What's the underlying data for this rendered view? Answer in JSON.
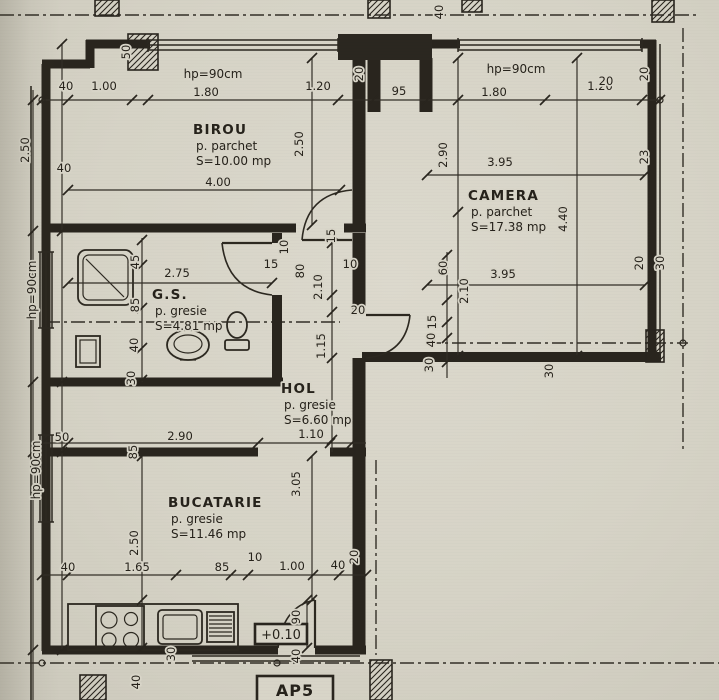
{
  "colors": {
    "paper": "#d8d5c8",
    "ink": "#26221b"
  },
  "plan": {
    "rooms": [
      {
        "id": "birou",
        "name": "BIROU",
        "floor_finish": "p. parchet",
        "area": "S=10.00 mp",
        "x": 193,
        "y": 134
      },
      {
        "id": "camera",
        "name": "CAMERA",
        "floor_finish": "p. parchet",
        "area": "S=17.38 mp",
        "x": 468,
        "y": 200
      },
      {
        "id": "gs",
        "name": "G.S.",
        "floor_finish": "p. gresie",
        "area": "S=4.81 mp",
        "x": 152,
        "y": 299
      },
      {
        "id": "hol",
        "name": "HOL",
        "floor_finish": "p. gresie",
        "area": "S=6.60 mp",
        "x": 281,
        "y": 393
      },
      {
        "id": "bucatarie",
        "name": "BUCATARIE",
        "floor_finish": "p. gresie",
        "area": "S=11.46 mp",
        "x": 168,
        "y": 507
      }
    ],
    "window_labels": [
      {
        "text": "hp=90cm",
        "x": 213,
        "y": 78,
        "r": 0
      },
      {
        "text": "hp=90cm",
        "x": 516,
        "y": 73,
        "r": 0
      },
      {
        "text": "hp=90cm",
        "x": 36,
        "y": 290,
        "r": -90
      },
      {
        "text": "hp=90cm",
        "x": 40,
        "y": 470,
        "r": -90
      }
    ],
    "level_marker": "+0.10",
    "plan_code": "AP5",
    "dims": [
      {
        "t": "40",
        "x": 66,
        "y": 90,
        "r": 0
      },
      {
        "t": "1.00",
        "x": 104,
        "y": 90,
        "r": 0
      },
      {
        "t": "1.80",
        "x": 206,
        "y": 96,
        "r": 0
      },
      {
        "t": "1.20",
        "x": 318,
        "y": 90,
        "r": 0
      },
      {
        "t": "95",
        "x": 399,
        "y": 95,
        "r": 0
      },
      {
        "t": "1.80",
        "x": 494,
        "y": 96,
        "r": 0
      },
      {
        "t": "1.20",
        "x": 600,
        "y": 90,
        "r": 0
      },
      {
        "t": "50",
        "x": 130,
        "y": 52,
        "r": -90
      },
      {
        "t": "40",
        "x": 443,
        "y": 12,
        "r": -90
      },
      {
        "t": "20",
        "x": 606,
        "y": 85,
        "r": 0
      },
      {
        "t": "20",
        "x": 648,
        "y": 74,
        "r": -90
      },
      {
        "t": "20",
        "x": 363,
        "y": 74,
        "r": -90
      },
      {
        "t": "2.50",
        "x": 29,
        "y": 150,
        "r": -90
      },
      {
        "t": "40",
        "x": 64,
        "y": 172,
        "r": 0
      },
      {
        "t": "2.50",
        "x": 303,
        "y": 144,
        "r": -90
      },
      {
        "t": "4.00",
        "x": 218,
        "y": 186,
        "r": 0
      },
      {
        "t": "2.90",
        "x": 447,
        "y": 155,
        "r": -90
      },
      {
        "t": "3.95",
        "x": 500,
        "y": 166,
        "r": 0
      },
      {
        "t": "4.40",
        "x": 567,
        "y": 219,
        "r": -90
      },
      {
        "t": "23",
        "x": 648,
        "y": 157,
        "r": -90
      },
      {
        "t": "3.95",
        "x": 503,
        "y": 278,
        "r": 0
      },
      {
        "t": "2.10",
        "x": 468,
        "y": 291,
        "r": -90
      },
      {
        "t": "60",
        "x": 447,
        "y": 268,
        "r": -90
      },
      {
        "t": "15",
        "x": 436,
        "y": 322,
        "r": -90
      },
      {
        "t": "40",
        "x": 435,
        "y": 340,
        "r": -90
      },
      {
        "t": "30",
        "x": 433,
        "y": 365,
        "r": -90
      },
      {
        "t": "30",
        "x": 553,
        "y": 371,
        "r": -90
      },
      {
        "t": "20",
        "x": 643,
        "y": 263,
        "r": -90
      },
      {
        "t": "30",
        "x": 664,
        "y": 263,
        "r": -90
      },
      {
        "t": "45",
        "x": 139,
        "y": 262,
        "r": -90
      },
      {
        "t": "85",
        "x": 139,
        "y": 305,
        "r": -90
      },
      {
        "t": "40",
        "x": 138,
        "y": 345,
        "r": -90
      },
      {
        "t": "30",
        "x": 135,
        "y": 378,
        "r": -90
      },
      {
        "t": "2.75",
        "x": 177,
        "y": 277,
        "r": 0
      },
      {
        "t": "15",
        "x": 271,
        "y": 268,
        "r": 0
      },
      {
        "t": "15",
        "x": 335,
        "y": 236,
        "r": -90
      },
      {
        "t": "10",
        "x": 288,
        "y": 247,
        "r": -90
      },
      {
        "t": "80",
        "x": 304,
        "y": 271,
        "r": -90
      },
      {
        "t": "2.10",
        "x": 322,
        "y": 287,
        "r": -90
      },
      {
        "t": "10",
        "x": 350,
        "y": 268,
        "r": 0
      },
      {
        "t": "20",
        "x": 358,
        "y": 314,
        "r": 0
      },
      {
        "t": "1.15",
        "x": 325,
        "y": 346,
        "r": -90
      },
      {
        "t": "50",
        "x": 62,
        "y": 441,
        "r": 0
      },
      {
        "t": "2.90",
        "x": 180,
        "y": 440,
        "r": 0
      },
      {
        "t": "1.10",
        "x": 311,
        "y": 438,
        "r": 0
      },
      {
        "t": "85",
        "x": 137,
        "y": 452,
        "r": -90
      },
      {
        "t": "3.05",
        "x": 300,
        "y": 484,
        "r": -90
      },
      {
        "t": "2.50",
        "x": 138,
        "y": 543,
        "r": -90
      },
      {
        "t": "40",
        "x": 68,
        "y": 571,
        "r": 0
      },
      {
        "t": "1.65",
        "x": 137,
        "y": 571,
        "r": 0
      },
      {
        "t": "85",
        "x": 222,
        "y": 571,
        "r": 0
      },
      {
        "t": "10",
        "x": 255,
        "y": 561,
        "r": 0
      },
      {
        "t": "1.00",
        "x": 292,
        "y": 570,
        "r": 0
      },
      {
        "t": "40",
        "x": 338,
        "y": 569,
        "r": 0
      },
      {
        "t": "20",
        "x": 358,
        "y": 557,
        "r": -90
      },
      {
        "t": "30",
        "x": 175,
        "y": 654,
        "r": -90
      },
      {
        "t": "90",
        "x": 300,
        "y": 617,
        "r": -90
      },
      {
        "t": "40",
        "x": 300,
        "y": 656,
        "r": -90
      },
      {
        "t": "40",
        "x": 140,
        "y": 682,
        "r": -90
      }
    ]
  }
}
